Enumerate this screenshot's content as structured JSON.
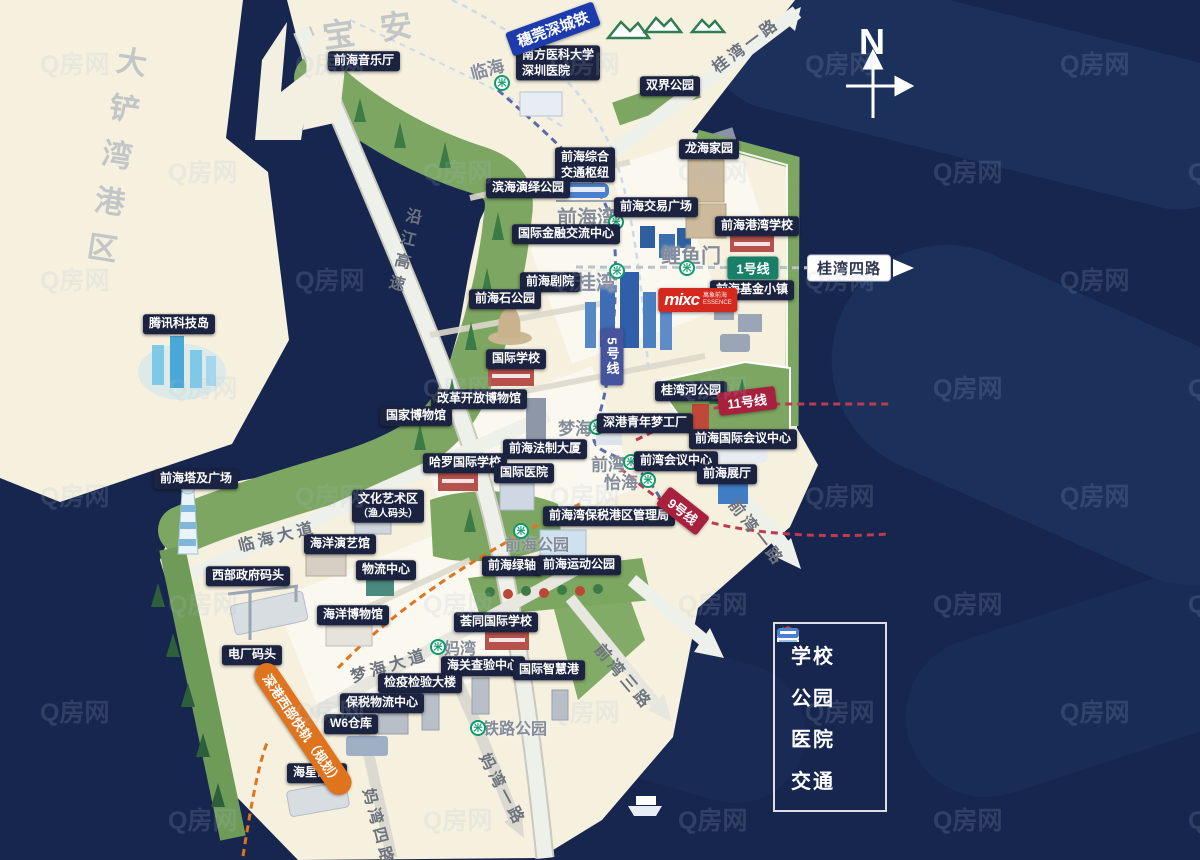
{
  "colors": {
    "water": "#17264e",
    "land": "#f6f1df",
    "green_belt": "#7ca661",
    "badge_bg": "#1b2340",
    "line1": "#187f68",
    "line5": "#46549e",
    "line9": "#a7203e",
    "line11": "#a7203e",
    "intercity": "#1c3cae",
    "planned_rail": "#e0731d",
    "mixc_red": "#d5281f",
    "metro_green": "#0c9a6b"
  },
  "regions": [
    {
      "text": "大铲湾港区",
      "x": 112,
      "y": 162,
      "vertical": true,
      "rotate": 9,
      "size": 30,
      "spacing": 17
    },
    {
      "text": "宝安",
      "x": 380,
      "y": 27,
      "rotate": -8,
      "size": 32,
      "spacing": 26
    }
  ],
  "pois": [
    {
      "text": "前海音乐厅",
      "x": 364,
      "y": 61
    },
    {
      "lines": [
        "南方医科大学",
        "深圳医院"
      ],
      "x": 558,
      "y": 63,
      "align": "left"
    },
    {
      "text": "双界公园",
      "x": 670,
      "y": 86
    },
    {
      "text": "龙海家园",
      "x": 709,
      "y": 149
    },
    {
      "lines": [
        "前海综合",
        "交通枢纽"
      ],
      "x": 585,
      "y": 165
    },
    {
      "text": "滨海演绎公园",
      "x": 528,
      "y": 188
    },
    {
      "text": "前海交易广场",
      "x": 656,
      "y": 207
    },
    {
      "text": "国际金融交流中心",
      "x": 566,
      "y": 234
    },
    {
      "text": "前海港湾学校",
      "x": 757,
      "y": 226
    },
    {
      "text": "前海剧院",
      "x": 550,
      "y": 282
    },
    {
      "text": "前海基金小镇",
      "x": 752,
      "y": 290
    },
    {
      "text": "前海石公园",
      "x": 505,
      "y": 299
    },
    {
      "text": "国际学校",
      "x": 516,
      "y": 359
    },
    {
      "text": "腾讯科技岛",
      "x": 179,
      "y": 324
    },
    {
      "text": "改革开放博物馆",
      "x": 479,
      "y": 399
    },
    {
      "text": "国家博物馆",
      "x": 416,
      "y": 416
    },
    {
      "text": "桂湾河公园",
      "x": 691,
      "y": 391
    },
    {
      "text": "深港青年梦工厂",
      "x": 645,
      "y": 423
    },
    {
      "text": "前海国际会议中心",
      "x": 743,
      "y": 439
    },
    {
      "text": "前海法制大厦",
      "x": 545,
      "y": 449
    },
    {
      "text": "哈罗国际学校",
      "x": 465,
      "y": 463
    },
    {
      "text": "前湾会议中心",
      "x": 676,
      "y": 461
    },
    {
      "text": "国际医院",
      "x": 524,
      "y": 473
    },
    {
      "text": "前海展厅",
      "x": 727,
      "y": 474
    },
    {
      "text": "前海塔及广场",
      "x": 196,
      "y": 479
    },
    {
      "lines": [
        "文化艺术区",
        "（渔人码头）"
      ],
      "x": 388,
      "y": 506,
      "small2": true
    },
    {
      "text": "海洋演艺馆",
      "x": 340,
      "y": 544
    },
    {
      "text": "前海湾保税港区管理局",
      "x": 609,
      "y": 516
    },
    {
      "text": "西部政府码头",
      "x": 248,
      "y": 576
    },
    {
      "text": "物流中心",
      "x": 386,
      "y": 570
    },
    {
      "text": "前海绿轴",
      "x": 512,
      "y": 566
    },
    {
      "text": "前海运动公园",
      "x": 579,
      "y": 565
    },
    {
      "text": "海洋博物馆",
      "x": 353,
      "y": 615
    },
    {
      "text": "荟同国际学校",
      "x": 496,
      "y": 622
    },
    {
      "text": "电厂码头",
      "x": 252,
      "y": 655
    },
    {
      "text": "海关查验中心",
      "x": 483,
      "y": 666
    },
    {
      "text": "国际智慧港",
      "x": 549,
      "y": 670
    },
    {
      "text": "检疫检验大楼",
      "x": 420,
      "y": 683
    },
    {
      "text": "保税物流中心",
      "x": 382,
      "y": 703
    },
    {
      "text": "W6仓库",
      "x": 351,
      "y": 724
    },
    {
      "text": "海星码头",
      "x": 317,
      "y": 773
    }
  ],
  "stations": [
    {
      "text": "临海",
      "x": 487,
      "y": 68,
      "rotate": -15,
      "size": 17,
      "icon_x": 502,
      "icon_y": 83
    },
    {
      "text": "前海湾",
      "x": 587,
      "y": 216,
      "size": 20,
      "icon_x": 616,
      "icon_y": 222
    },
    {
      "text": "桂湾",
      "x": 596,
      "y": 281,
      "size": 20,
      "icon_x": 617,
      "icon_y": 271
    },
    {
      "text": "鲤鱼门",
      "x": 691,
      "y": 254,
      "size": 20,
      "icon_x": 687,
      "icon_y": 268
    },
    {
      "text": "梦海",
      "x": 575,
      "y": 427,
      "size": 17,
      "icon_x": 597,
      "icon_y": 427
    },
    {
      "text": "前湾",
      "x": 608,
      "y": 463,
      "size": 17,
      "icon_x": 631,
      "icon_y": 462
    },
    {
      "text": "怡海",
      "x": 621,
      "y": 481,
      "size": 17,
      "icon_x": 648,
      "icon_y": 480
    },
    {
      "text": "前海公园",
      "x": 537,
      "y": 543,
      "size": 16,
      "icon_x": 521,
      "icon_y": 531
    },
    {
      "text": "妈湾",
      "x": 460,
      "y": 647,
      "size": 16,
      "icon_x": 438,
      "icon_y": 647
    },
    {
      "text": "铁路公园",
      "x": 515,
      "y": 727,
      "size": 16,
      "icon_x": 478,
      "icon_y": 728
    }
  ],
  "metro": {
    "glyph": "米"
  },
  "line_badges": [
    {
      "text": "穗莞深城铁",
      "x": 553,
      "y": 29,
      "color": "#1c3cae",
      "rotate": -20,
      "size": 15
    },
    {
      "text": "1号线",
      "x": 753,
      "y": 268,
      "color": "#187f68"
    },
    {
      "text": "5号线",
      "x": 612,
      "y": 357,
      "color": "#46549e",
      "vertical": true
    },
    {
      "text": "11号线",
      "x": 747,
      "y": 401,
      "color": "#a7203e",
      "rotate": -7
    },
    {
      "text": "9号线",
      "x": 683,
      "y": 511,
      "color": "#a7203e",
      "rotate": 38
    },
    {
      "text": "深港西部快轨（规划）",
      "x": 303,
      "y": 729,
      "color": "#e0731d",
      "rotate": 56,
      "pill": true
    }
  ],
  "road_labels": [
    {
      "text": "沿江高速",
      "x": 402,
      "y": 252,
      "rotate": 14,
      "vertical": true
    },
    {
      "text": "桂湾一路",
      "x": 745,
      "y": 44,
      "rotate": -37
    },
    {
      "text": "桂湾四路",
      "x": 849,
      "y": 268,
      "badge": true
    },
    {
      "text": "临海大道",
      "x": 277,
      "y": 535,
      "rotate": -14
    },
    {
      "text": "梦海大道",
      "x": 389,
      "y": 664,
      "rotate": -17
    },
    {
      "text": "前湾一路",
      "x": 758,
      "y": 532,
      "rotate": 52
    },
    {
      "text": "前湾三路",
      "x": 625,
      "y": 676,
      "rotate": 50
    },
    {
      "text": "妈湾一路",
      "x": 504,
      "y": 789,
      "rotate": 62
    },
    {
      "text": "妈湾四路",
      "x": 380,
      "y": 827,
      "rotate": 75
    }
  ],
  "mixc": {
    "logo": "mixc",
    "sub1": "萬象前海",
    "sub2": "ESSENCE",
    "x": 698,
    "y": 300
  },
  "compass": {
    "label": "N",
    "x": 872,
    "y": 42
  },
  "legend": {
    "items": [
      {
        "label": "学校",
        "icon": "school-icon"
      },
      {
        "label": "公园",
        "icon": "park-icon"
      },
      {
        "label": "医院",
        "icon": "hospital-icon"
      },
      {
        "label": "交通",
        "icon": "transit-icon"
      }
    ]
  },
  "watermark": {
    "text": "Q房网"
  }
}
